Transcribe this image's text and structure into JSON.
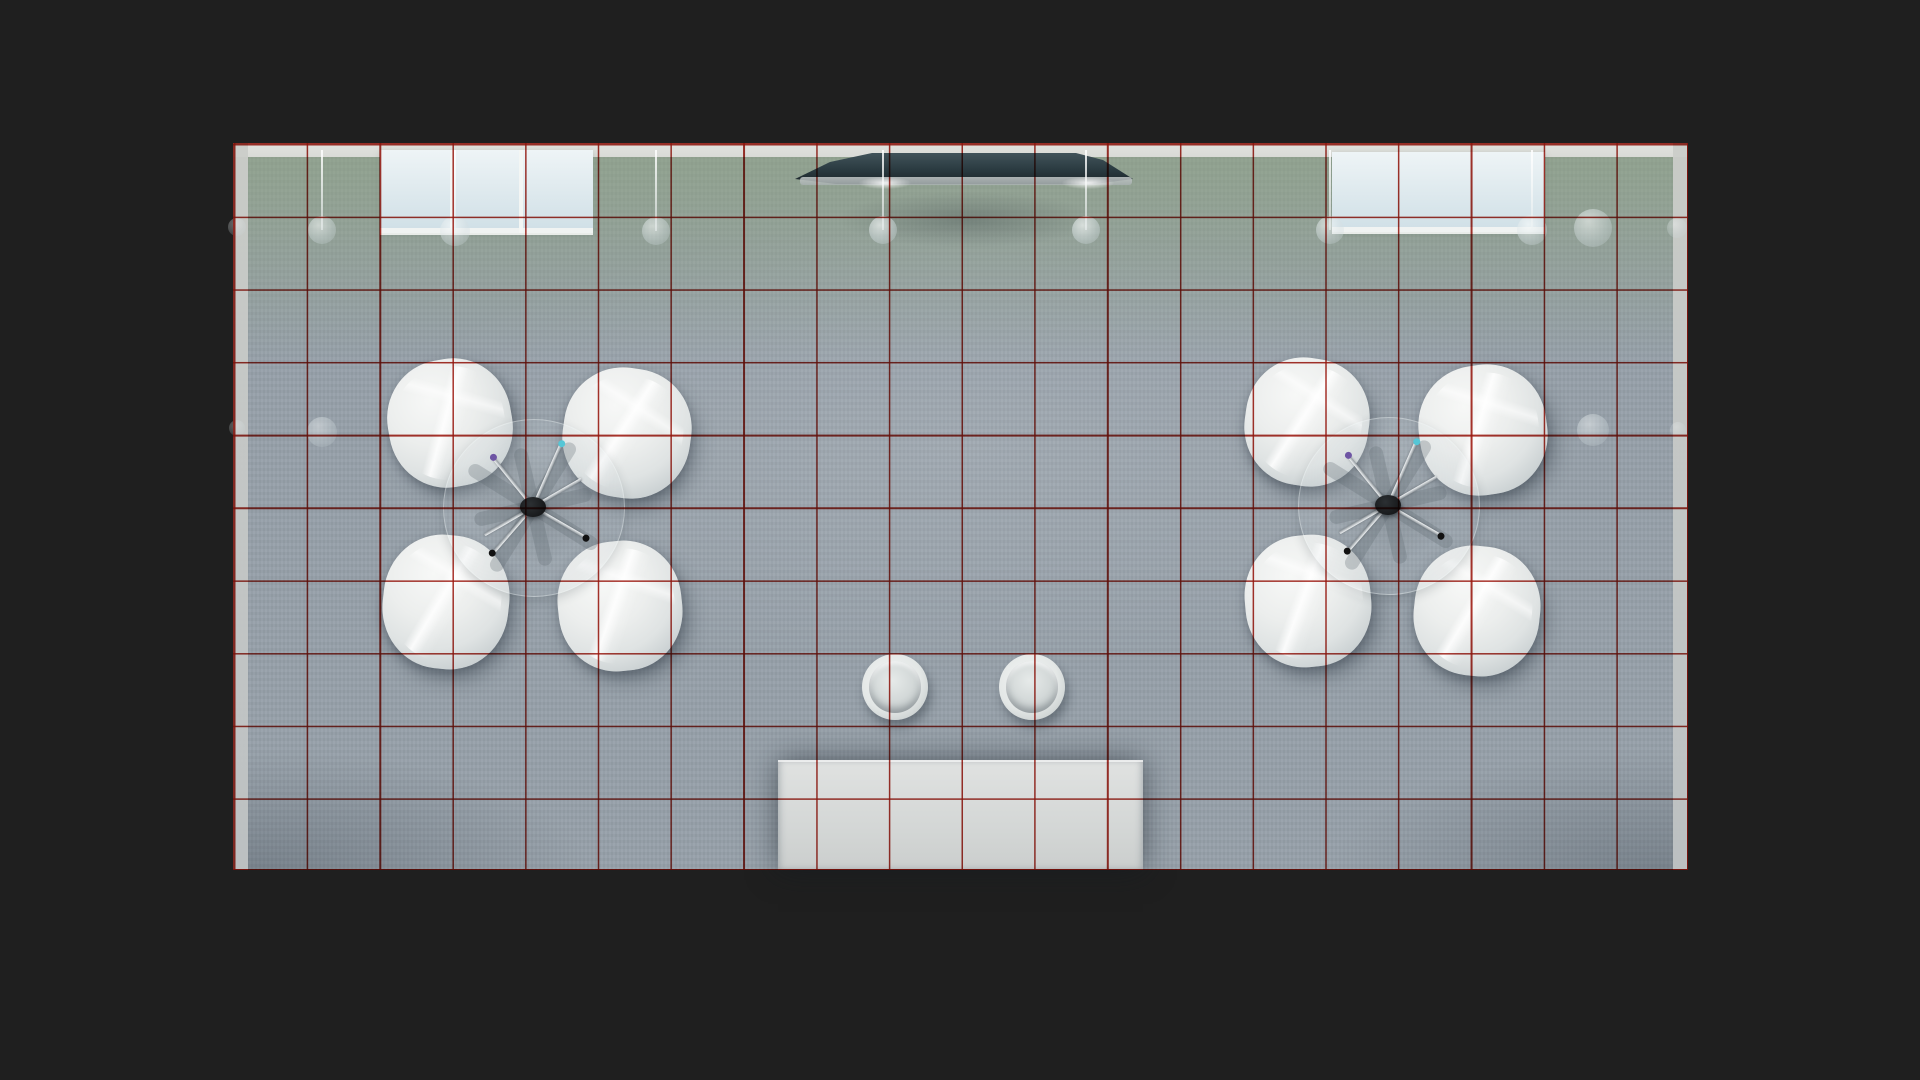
{
  "scene": {
    "description": "photorealistic top-down 3d render of an exhibition room with red measurement grid overlay",
    "palette": {
      "background": "#1f1f1f",
      "floor_base": "#97a1aa",
      "floor_green_band": "rgba(140,163,122,0.55)",
      "floor_green_mid": "rgba(140,163,122,0.40)",
      "floor_green_fade": "rgba(140,163,122,0)",
      "floor_center_glow": "rgba(255,255,255,0.10)",
      "floor_corner_shade": "rgba(50,60,70,0.30)",
      "floor_texture_light": "rgba(255,255,255,0.02)",
      "floor_texture_dark": "rgba(0,0,0,0.022)",
      "grid_line": "rgba(158,23,14,0.88)",
      "wall_strip": "#cbcdc9",
      "top_wall": "#d9dad6",
      "window_glass_light": "#eef4f6",
      "window_glass_dark": "#cfdfe6",
      "mullion": "#f3f5f3",
      "canopy_top": "#41535a",
      "canopy_mid": "#2a3a40",
      "canopy_bottom": "#1b2429",
      "canopy_bar": "#a8b0b0",
      "lamp_glass": "rgba(248,251,251,0.95)",
      "chair_highlight": "#f7f8f7",
      "chair_mid": "#eceeed",
      "chair_shade": "#b2babe",
      "stool_outer": "#f2f4f3",
      "stool_inner": "#ccd2d2",
      "table_top": "#e0e2e1",
      "table_mid": "#d3d6d5",
      "leg_metal": "#c9ced1",
      "blade": "rgba(95,105,112,0.28)",
      "hub_dark": "#17191b",
      "tip_cyan": "#55c6d6",
      "tip_purple": "#6e55a4",
      "tip_black": "#121212"
    },
    "floor": {
      "x": 233,
      "y": 143,
      "width": 1455,
      "height": 727
    },
    "grid": {
      "columns": 20,
      "rows": 10,
      "line_thickness": 1.6
    },
    "walls": {
      "top_height": 14,
      "side_width": 15
    },
    "windows": [
      {
        "name": "window-top-left",
        "x": 380,
        "y": 150,
        "width": 213,
        "height": 83,
        "mullions": [
          452,
          521
        ]
      },
      {
        "name": "window-top-right",
        "x": 1332,
        "y": 152,
        "width": 213,
        "height": 80,
        "mullions": []
      }
    ],
    "canopy": {
      "points": [
        [
          795,
          179
        ],
        [
          830,
          162
        ],
        [
          872,
          153
        ],
        [
          1076,
          153
        ],
        [
          1103,
          160
        ],
        [
          1133,
          179
        ],
        [
          1095,
          184
        ],
        [
          836,
          184
        ]
      ],
      "bar": {
        "x": 800,
        "y": 177,
        "width": 332,
        "height": 8
      },
      "glows": [
        {
          "x": 885,
          "y": 183
        },
        {
          "x": 1088,
          "y": 183
        }
      ],
      "floor_shadow": {
        "x": 795,
        "y": 182,
        "width": 345,
        "height": 75
      }
    },
    "hang_rod_top": 150,
    "ceiling_lamps": [
      {
        "x": 237,
        "y": 227,
        "r": 9,
        "o": 0.35,
        "rod": false
      },
      {
        "x": 322,
        "y": 230,
        "r": 14,
        "o": 0.6,
        "rod": true
      },
      {
        "x": 455,
        "y": 231,
        "r": 15,
        "o": 0.65,
        "rod": true
      },
      {
        "x": 656,
        "y": 231,
        "r": 14,
        "o": 0.6,
        "rod": true
      },
      {
        "x": 883,
        "y": 230,
        "r": 14,
        "o": 0.72,
        "rod": true
      },
      {
        "x": 1086,
        "y": 230,
        "r": 14,
        "o": 0.72,
        "rod": true
      },
      {
        "x": 1330,
        "y": 230,
        "r": 14,
        "o": 0.65,
        "rod": true
      },
      {
        "x": 1532,
        "y": 230,
        "r": 15,
        "o": 0.7,
        "rod": true
      },
      {
        "x": 1593,
        "y": 228,
        "r": 19,
        "o": 0.6,
        "rod": false
      },
      {
        "x": 1677,
        "y": 228,
        "r": 10,
        "o": 0.4,
        "rod": false
      },
      {
        "x": 322,
        "y": 432,
        "r": 15,
        "o": 0.45,
        "rod": false
      },
      {
        "x": 237,
        "y": 428,
        "r": 8,
        "o": 0.3,
        "rod": false
      },
      {
        "x": 1593,
        "y": 430,
        "r": 16,
        "o": 0.5,
        "rod": false
      },
      {
        "x": 1678,
        "y": 430,
        "r": 8,
        "o": 0.3,
        "rod": false
      }
    ],
    "seating_clusters": [
      {
        "name": "seating-cluster-left",
        "hub": {
          "x": 533,
          "y": 507
        },
        "glass_radius": 90,
        "chairs": [
          {
            "cx": 450,
            "cy": 423,
            "w": 124,
            "h": 128,
            "rot": -10
          },
          {
            "cx": 627,
            "cy": 433,
            "w": 128,
            "h": 130,
            "rot": 8
          },
          {
            "cx": 446,
            "cy": 602,
            "w": 126,
            "h": 134,
            "rot": 6
          },
          {
            "cx": 620,
            "cy": 606,
            "w": 124,
            "h": 130,
            "rot": -6
          }
        ]
      },
      {
        "name": "seating-cluster-right",
        "hub": {
          "x": 1388,
          "y": 505
        },
        "glass_radius": 90,
        "chairs": [
          {
            "cx": 1307,
            "cy": 422,
            "w": 124,
            "h": 128,
            "rot": 8
          },
          {
            "cx": 1483,
            "cy": 430,
            "w": 128,
            "h": 130,
            "rot": -8
          },
          {
            "cx": 1308,
            "cy": 601,
            "w": 126,
            "h": 132,
            "rot": -5
          },
          {
            "cx": 1477,
            "cy": 611,
            "w": 126,
            "h": 130,
            "rot": 6
          }
        ]
      }
    ],
    "base_blades": [
      {
        "angle": 32,
        "len": 150
      },
      {
        "angle": 122,
        "len": 150
      },
      {
        "angle": 77,
        "len": 120
      },
      {
        "angle": 347,
        "len": 120
      }
    ],
    "base_legs": [
      {
        "angle": 24,
        "len": 70,
        "tip": "cyan"
      },
      {
        "angle": -39,
        "len": 64,
        "tip": "purple"
      },
      {
        "angle": 221,
        "len": 62,
        "tip": "black"
      },
      {
        "angle": 120,
        "len": 62,
        "tip": "black"
      },
      {
        "angle": -120,
        "len": 56,
        "tip": "none"
      },
      {
        "angle": 60,
        "len": 56,
        "tip": "none"
      }
    ],
    "stools": [
      {
        "cx": 895,
        "cy": 687,
        "d": 66
      },
      {
        "cx": 1032,
        "cy": 687,
        "d": 66
      }
    ],
    "service_table": {
      "x": 778,
      "y": 760,
      "width": 365,
      "height": 110
    }
  }
}
